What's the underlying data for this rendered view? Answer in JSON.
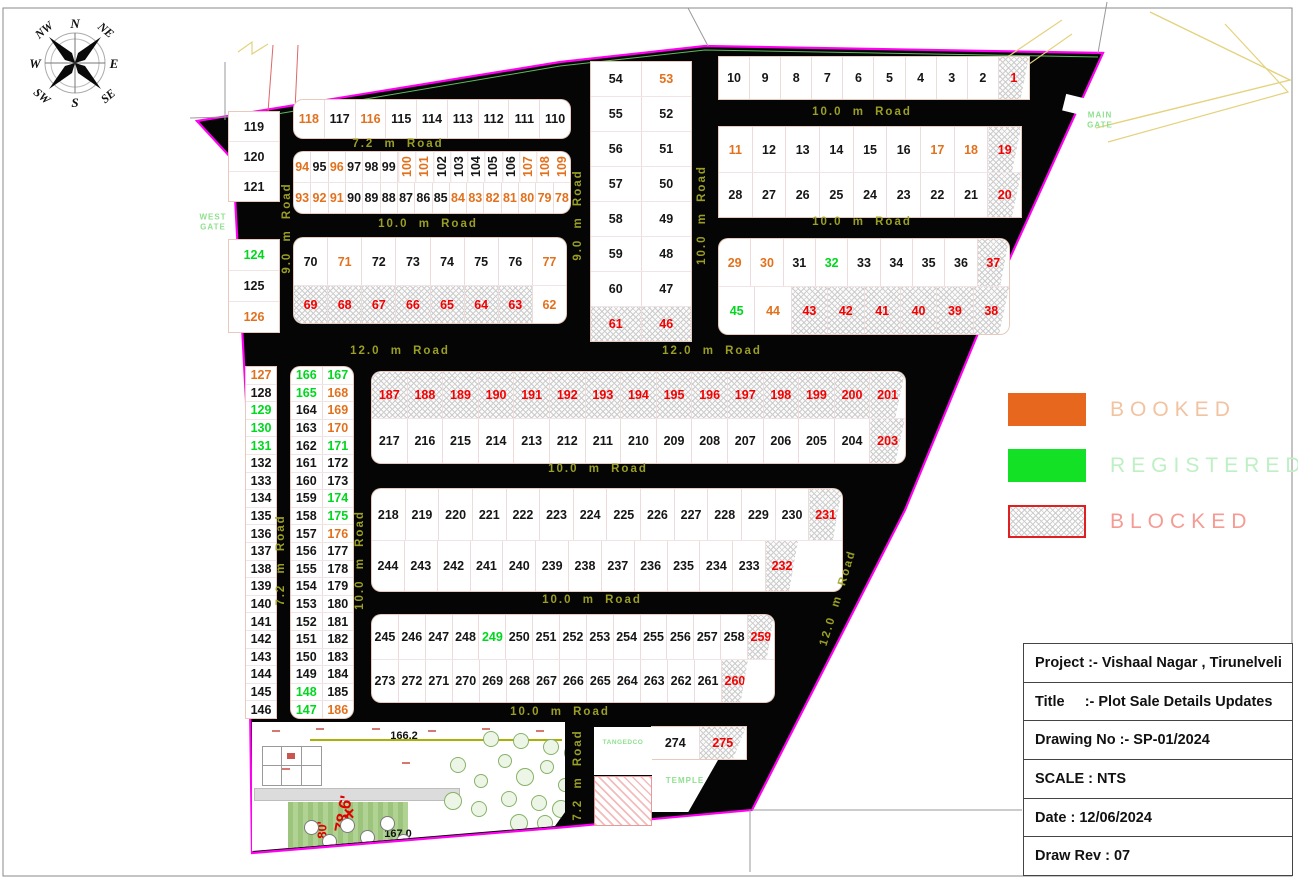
{
  "title_block": {
    "rows": [
      "Project :- Vishaal Nagar , Tirunelveli",
      "Title     :- Plot Sale Details Updates",
      "Drawing No :- SP-01/2024",
      "SCALE : NTS",
      "Date : 12/06/2024",
      "Draw Rev : 07"
    ]
  },
  "legend": {
    "items": [
      {
        "label": "BOOKED",
        "swatch": "#E8671F",
        "label_color": "#F2C3A1"
      },
      {
        "label": "REGISTERED",
        "swatch": "#12E126",
        "label_color": "#BFEFC4"
      },
      {
        "label": "BLOCKED",
        "swatch": "hatch",
        "label_color": "#F59B94"
      }
    ]
  },
  "compass": {
    "points": [
      "N",
      "NE",
      "E",
      "SE",
      "S",
      "SW",
      "W",
      "NW"
    ]
  },
  "gates": {
    "west": "WEST\nGATE",
    "main": "MAIN\nGATE"
  },
  "site_labels": {
    "tangedco": "TANGEDCO",
    "temple": "TEMPLE"
  },
  "park_labels": {
    "level_top": "166.2",
    "level_bottom": "167.0",
    "dim1": "78.6'",
    "dim2": "80'"
  },
  "colors": {
    "boundary": "#FF00F0",
    "road_fill": "#050505",
    "booked": "#E2711D",
    "registered": "#00D71E",
    "blocked": "#F40000",
    "road_text": "#A2A726"
  },
  "road_labels": [
    {
      "t": "7.2 m Road",
      "x": 398,
      "y": 144,
      "r": 0
    },
    {
      "t": "10.0 m Road",
      "x": 428,
      "y": 224,
      "r": 0
    },
    {
      "t": "12.0 m Road",
      "x": 400,
      "y": 351,
      "r": 0
    },
    {
      "t": "12.0 m Road",
      "x": 712,
      "y": 351,
      "r": 0
    },
    {
      "t": "10.0 m Road",
      "x": 862,
      "y": 112,
      "r": 0
    },
    {
      "t": "10.0 m Road",
      "x": 862,
      "y": 222,
      "r": 0
    },
    {
      "t": "10.0 m Road",
      "x": 598,
      "y": 469,
      "r": 0
    },
    {
      "t": "10.0 m Road",
      "x": 592,
      "y": 600,
      "r": 0
    },
    {
      "t": "10.0 m Road",
      "x": 560,
      "y": 712,
      "r": 0
    },
    {
      "t": "9.0 m Road",
      "x": 287,
      "y": 228,
      "r": -90
    },
    {
      "t": "9.0 m Road",
      "x": 578,
      "y": 215,
      "r": -90
    },
    {
      "t": "10.0 m Road",
      "x": 702,
      "y": 215,
      "r": -90
    },
    {
      "t": "7.2 m Road",
      "x": 281,
      "y": 560,
      "r": -90
    },
    {
      "t": "10.0 m Road",
      "x": 360,
      "y": 560,
      "r": -90
    },
    {
      "t": "7.2 m Road",
      "x": 578,
      "y": 775,
      "r": -90
    },
    {
      "t": "12.0 m Road",
      "x": 838,
      "y": 598,
      "r": -73
    }
  ],
  "map": {
    "blocks": [
      {
        "id": "col-119-121",
        "x": 229,
        "y": 112,
        "w": 50,
        "round": false,
        "rows": [
          {
            "h": 29,
            "cells": [
              "119"
            ]
          },
          {
            "h": 29,
            "cells": [
              "120"
            ]
          },
          {
            "h": 29,
            "cells": [
              "121"
            ]
          }
        ]
      },
      {
        "id": "row-118-110",
        "x": 294,
        "y": 100,
        "w": 276,
        "round": true,
        "rows": [
          {
            "h": 38,
            "cells": [
              "118b",
              "117",
              "116b",
              "115",
              "114",
              "113",
              "112",
              "111",
              "110"
            ]
          }
        ]
      },
      {
        "id": "grid-94-78",
        "x": 294,
        "y": 152,
        "w": 276,
        "round": true,
        "rows": [
          {
            "h": 30,
            "cells": [
              "94b",
              "95",
              "96b",
              "97",
              "98",
              "99",
              "100bv",
              "101bv",
              "102v",
              "103v",
              "104v",
              "105v",
              "106v",
              "107bv",
              "108bv",
              "109bv"
            ]
          },
          {
            "h": 30,
            "cells": [
              "93b",
              "92b",
              "91b",
              "90",
              "89",
              "88",
              "87",
              "86",
              "85",
              "84b",
              "83b",
              "82b",
              "81b",
              "80b",
              "79b",
              "78b"
            ]
          }
        ]
      },
      {
        "id": "col-124-126",
        "x": 229,
        "y": 240,
        "w": 50,
        "round": false,
        "rows": [
          {
            "h": 30,
            "cells": [
              "124r"
            ]
          },
          {
            "h": 30,
            "cells": [
              "125"
            ]
          },
          {
            "h": 30,
            "cells": [
              "126b"
            ]
          }
        ]
      },
      {
        "id": "grid-70-62",
        "x": 294,
        "y": 238,
        "w": 272,
        "round": true,
        "rows": [
          {
            "h": 47,
            "cells": [
              "70",
              "71b",
              "72",
              "73",
              "74",
              "75",
              "76",
              "77b"
            ]
          },
          {
            "h": 37,
            "cells": [
              "69x",
              "68x",
              "67x",
              "66x",
              "65x",
              "64x",
              "63x",
              "62b"
            ]
          }
        ]
      },
      {
        "id": "col-54-46",
        "x": 591,
        "y": 62,
        "w": 100,
        "round": false,
        "rows": [
          {
            "h": 34,
            "cells": [
              "54",
              "53b"
            ]
          },
          {
            "h": 34,
            "cells": [
              "55",
              "52"
            ]
          },
          {
            "h": 34,
            "cells": [
              "56",
              "51"
            ]
          },
          {
            "h": 34,
            "cells": [
              "57",
              "50"
            ]
          },
          {
            "h": 34,
            "cells": [
              "58",
              "49"
            ]
          },
          {
            "h": 34,
            "cells": [
              "59",
              "48"
            ]
          },
          {
            "h": 34,
            "cells": [
              "60",
              "47"
            ]
          },
          {
            "h": 34,
            "cells": [
              "61x",
              "46x"
            ]
          }
        ]
      },
      {
        "id": "row-10-1",
        "x": 719,
        "y": 57,
        "w": 310,
        "round": false,
        "rows": [
          {
            "h": 42,
            "cells": [
              "10",
              "9",
              "8",
              "7",
              "6",
              "5",
              "4",
              "3",
              "2",
              "1xw"
            ]
          }
        ]
      },
      {
        "id": "grid-11-20",
        "x": 719,
        "y": 127,
        "w": 302,
        "round": false,
        "rows": [
          {
            "h": 45,
            "cells": [
              "11b",
              "12",
              "13",
              "14",
              "15",
              "16",
              "17b",
              "18b",
              "19xw"
            ]
          },
          {
            "h": 44,
            "cells": [
              "28",
              "27",
              "26",
              "25",
              "24",
              "23",
              "22",
              "21",
              "20xw"
            ]
          }
        ]
      },
      {
        "id": "grid-29-38",
        "x": 719,
        "y": 239,
        "w": 290,
        "round": true,
        "rows": [
          {
            "h": 47,
            "cells": [
              "29b",
              "30b",
              "31",
              "32r",
              "33",
              "34",
              "35",
              "36",
              "37xw"
            ]
          },
          {
            "h": 47,
            "cells": [
              "45r",
              "44b",
              "43x",
              "42x",
              "41x",
              "40x",
              "39x",
              "38xw"
            ]
          }
        ]
      },
      {
        "id": "col-127-146",
        "x": 246,
        "y": 367,
        "w": 30,
        "round": false,
        "rows": [
          {
            "h": 16.6,
            "cells": [
              "127b"
            ]
          },
          {
            "h": 16.6,
            "cells": [
              "128"
            ]
          },
          {
            "h": 16.6,
            "cells": [
              "129r"
            ]
          },
          {
            "h": 16.6,
            "cells": [
              "130r"
            ]
          },
          {
            "h": 16.6,
            "cells": [
              "131r"
            ]
          },
          {
            "h": 16.6,
            "cells": [
              "132"
            ]
          },
          {
            "h": 16.6,
            "cells": [
              "133"
            ]
          },
          {
            "h": 16.6,
            "cells": [
              "134"
            ]
          },
          {
            "h": 16.6,
            "cells": [
              "135"
            ]
          },
          {
            "h": 16.6,
            "cells": [
              "136"
            ]
          },
          {
            "h": 16.6,
            "cells": [
              "137"
            ]
          },
          {
            "h": 16.6,
            "cells": [
              "138"
            ]
          },
          {
            "h": 16.6,
            "cells": [
              "139"
            ]
          },
          {
            "h": 16.6,
            "cells": [
              "140"
            ]
          },
          {
            "h": 16.6,
            "cells": [
              "141"
            ]
          },
          {
            "h": 16.6,
            "cells": [
              "142"
            ]
          },
          {
            "h": 16.6,
            "cells": [
              "143"
            ]
          },
          {
            "h": 16.6,
            "cells": [
              "144"
            ]
          },
          {
            "h": 16.6,
            "cells": [
              "145"
            ]
          },
          {
            "h": 16.6,
            "cells": [
              "146"
            ]
          }
        ]
      },
      {
        "id": "col-166-186",
        "x": 291,
        "y": 367,
        "w": 62,
        "round": true,
        "rows": [
          {
            "h": 16.6,
            "cells": [
              "166r",
              "167r"
            ]
          },
          {
            "h": 16.6,
            "cells": [
              "165r",
              "168b"
            ]
          },
          {
            "h": 16.6,
            "cells": [
              "164",
              "169b"
            ]
          },
          {
            "h": 16.6,
            "cells": [
              "163",
              "170b"
            ]
          },
          {
            "h": 16.6,
            "cells": [
              "162",
              "171r"
            ]
          },
          {
            "h": 16.6,
            "cells": [
              "161",
              "172"
            ]
          },
          {
            "h": 16.6,
            "cells": [
              "160",
              "173"
            ]
          },
          {
            "h": 16.6,
            "cells": [
              "159",
              "174r"
            ]
          },
          {
            "h": 16.6,
            "cells": [
              "158",
              "175r"
            ]
          },
          {
            "h": 16.6,
            "cells": [
              "157",
              "176b"
            ]
          },
          {
            "h": 16.6,
            "cells": [
              "156",
              "177"
            ]
          },
          {
            "h": 16.6,
            "cells": [
              "155",
              "178"
            ]
          },
          {
            "h": 16.6,
            "cells": [
              "154",
              "179"
            ]
          },
          {
            "h": 16.6,
            "cells": [
              "153",
              "180"
            ]
          },
          {
            "h": 16.6,
            "cells": [
              "152",
              "181"
            ]
          },
          {
            "h": 16.6,
            "cells": [
              "151",
              "182"
            ]
          },
          {
            "h": 16.6,
            "cells": [
              "150",
              "183"
            ]
          },
          {
            "h": 16.6,
            "cells": [
              "149",
              "184"
            ]
          },
          {
            "h": 16.6,
            "cells": [
              "148r",
              "185"
            ]
          },
          {
            "h": 16.6,
            "cells": [
              "147r",
              "186b"
            ]
          }
        ]
      },
      {
        "id": "grid-187-203",
        "x": 372,
        "y": 372,
        "w": 533,
        "round": true,
        "rows": [
          {
            "h": 46,
            "cells": [
              "187x",
              "188x",
              "189x",
              "190x",
              "191x",
              "192x",
              "193x",
              "194x",
              "195x",
              "196x",
              "197x",
              "198x",
              "199x",
              "200x",
              "201xw"
            ]
          },
          {
            "h": 44,
            "cells": [
              "217",
              "216",
              "215",
              "214",
              "213",
              "212",
              "211",
              "210",
              "209",
              "208",
              "207",
              "206",
              "205",
              "204",
              "203xw"
            ]
          }
        ]
      },
      {
        "id": "grid-218-232",
        "x": 372,
        "y": 489,
        "w": 470,
        "round": true,
        "rows": [
          {
            "h": 51,
            "cells": [
              "218",
              "219",
              "220",
              "221",
              "222",
              "223",
              "224",
              "225",
              "226",
              "227",
              "228",
              "229",
              "230",
              "231xw"
            ]
          },
          {
            "h": 50,
            "w": 426,
            "cells": [
              "244",
              "243",
              "242",
              "241",
              "240",
              "239",
              "238",
              "237",
              "236",
              "235",
              "234",
              "233",
              "232xw"
            ]
          }
        ]
      },
      {
        "id": "grid-245-260",
        "x": 372,
        "y": 615,
        "w": 402,
        "round": true,
        "rows": [
          {
            "h": 44,
            "cells": [
              "245",
              "246",
              "247",
              "248",
              "249r",
              "250",
              "251",
              "252",
              "253",
              "254",
              "255",
              "256",
              "257",
              "258",
              "259xw"
            ]
          },
          {
            "h": 42,
            "w": 376,
            "cells": [
              "273",
              "272",
              "271",
              "270",
              "269",
              "268",
              "267",
              "266",
              "265",
              "264",
              "263",
              "262",
              "261",
              "260xw"
            ]
          }
        ]
      },
      {
        "id": "row-274-275",
        "x": 652,
        "y": 727,
        "w": 94,
        "round": false,
        "rows": [
          {
            "h": 32,
            "cells": [
              "274",
              "275xw"
            ]
          }
        ]
      }
    ]
  }
}
